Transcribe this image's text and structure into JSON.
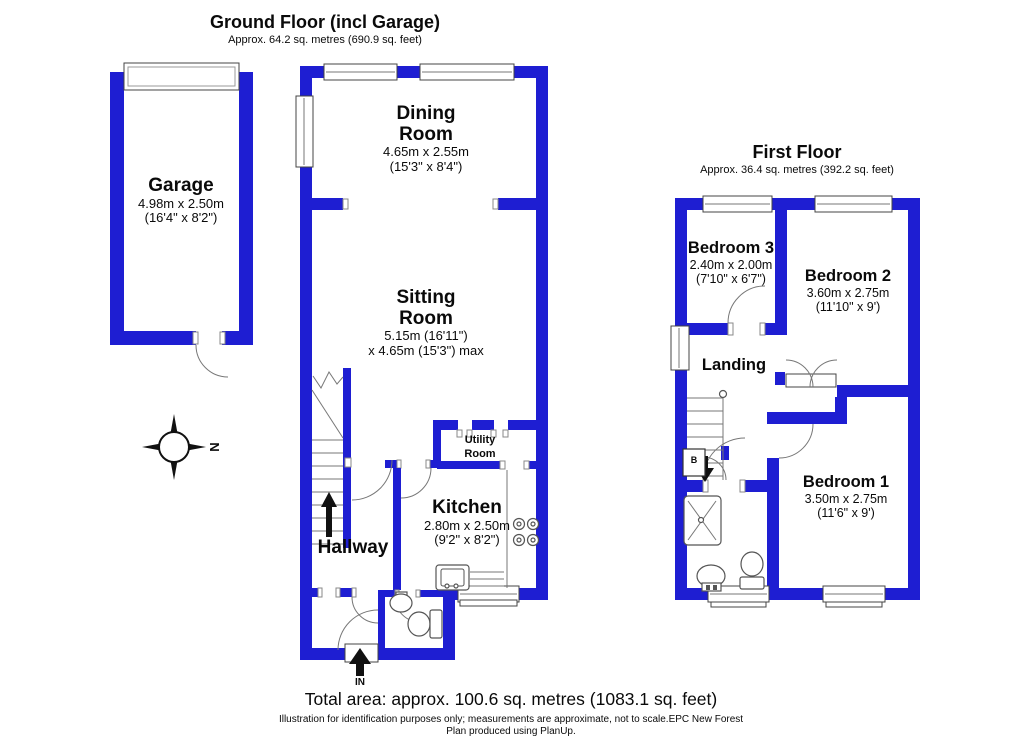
{
  "colors": {
    "wall": "#1e1ed2"
  },
  "ground_floor": {
    "title": "Ground Floor (incl Garage)",
    "subtitle": "Approx. 64.2 sq. metres (690.9 sq. feet)",
    "compass_north": "N",
    "entry_label": "IN",
    "rooms": {
      "garage": {
        "name": "Garage",
        "dims_metric": "4.98m x 2.50m",
        "dims_imperial": "(16'4\" x 8'2\")"
      },
      "dining": {
        "name_line1": "Dining",
        "name_line2": "Room",
        "dims_metric": "4.65m x 2.55m",
        "dims_imperial": "(15'3\" x 8'4\")"
      },
      "sitting": {
        "name_line1": "Sitting",
        "name_line2": "Room",
        "dims_line1": "5.15m (16'11\")",
        "dims_line2": "x 4.65m (15'3\") max"
      },
      "utility": {
        "name_line1": "Utility",
        "name_line2": "Room"
      },
      "kitchen": {
        "name": "Kitchen",
        "dims_metric": "2.80m x 2.50m",
        "dims_imperial": "(9'2\" x 8'2\")"
      },
      "hallway": {
        "name": "Hallway"
      }
    }
  },
  "first_floor": {
    "title": "First Floor",
    "subtitle": "Approx. 36.4 sq. metres (392.2 sq. feet)",
    "boiler_label": "B",
    "rooms": {
      "bedroom3": {
        "name": "Bedroom 3",
        "dims_metric": "2.40m x 2.00m",
        "dims_imperial": "(7'10\" x 6'7\")"
      },
      "bedroom2": {
        "name": "Bedroom 2",
        "dims_metric": "3.60m x 2.75m",
        "dims_imperial": "(11'10\" x 9')"
      },
      "bedroom1": {
        "name": "Bedroom 1",
        "dims_metric": "3.50m x 2.75m",
        "dims_imperial": "(11'6\" x 9')"
      },
      "landing": {
        "name": "Landing"
      }
    }
  },
  "footer": {
    "total_area": "Total area: approx. 100.6 sq. metres (1083.1 sq. feet)",
    "disclaimer_line1": "Illustration for identification purposes only; measurements are approximate, not to scale.EPC New Forest",
    "disclaimer_line2": "Plan produced using PlanUp."
  }
}
